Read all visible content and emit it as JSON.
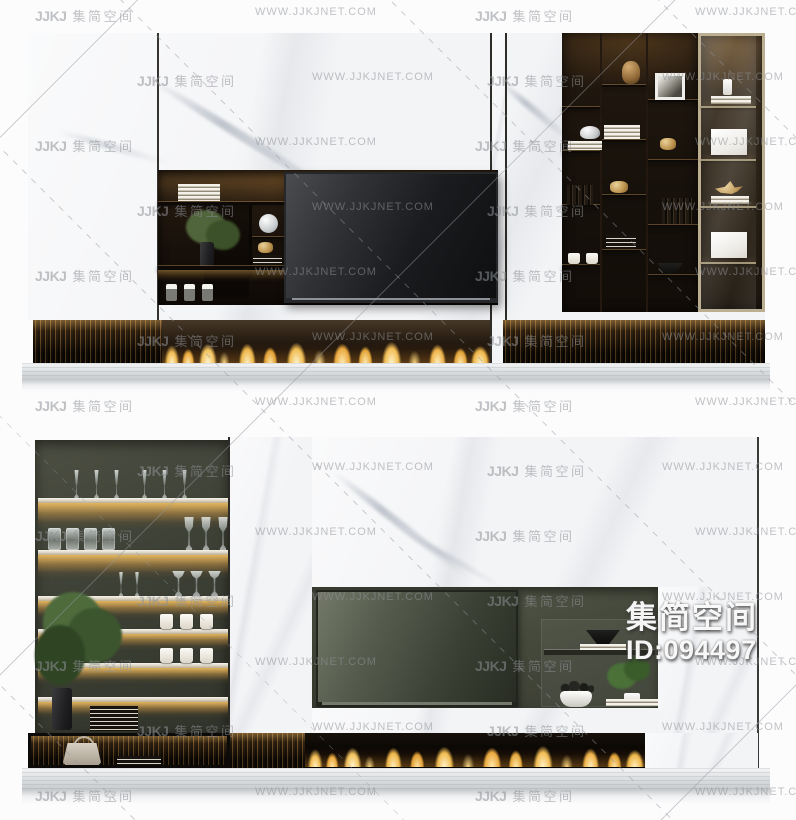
{
  "watermark": {
    "logo": "JJKJ",
    "brand": "集简空间",
    "website": "WWW.JJKJNET.COM"
  },
  "id_badge": {
    "brand": "集简空间",
    "id": "ID:094497"
  },
  "palette": {
    "background": "#fdfdfd",
    "marble_white": "#f3f4f6",
    "dark_wood": "#17110b",
    "olive_wall": "#3e4136",
    "warm_glow": "#e0a94e",
    "flame_gold": "#f2bd55",
    "cabinet_frame": "#bcae90",
    "watermark_gray": "#8f9296"
  }
}
